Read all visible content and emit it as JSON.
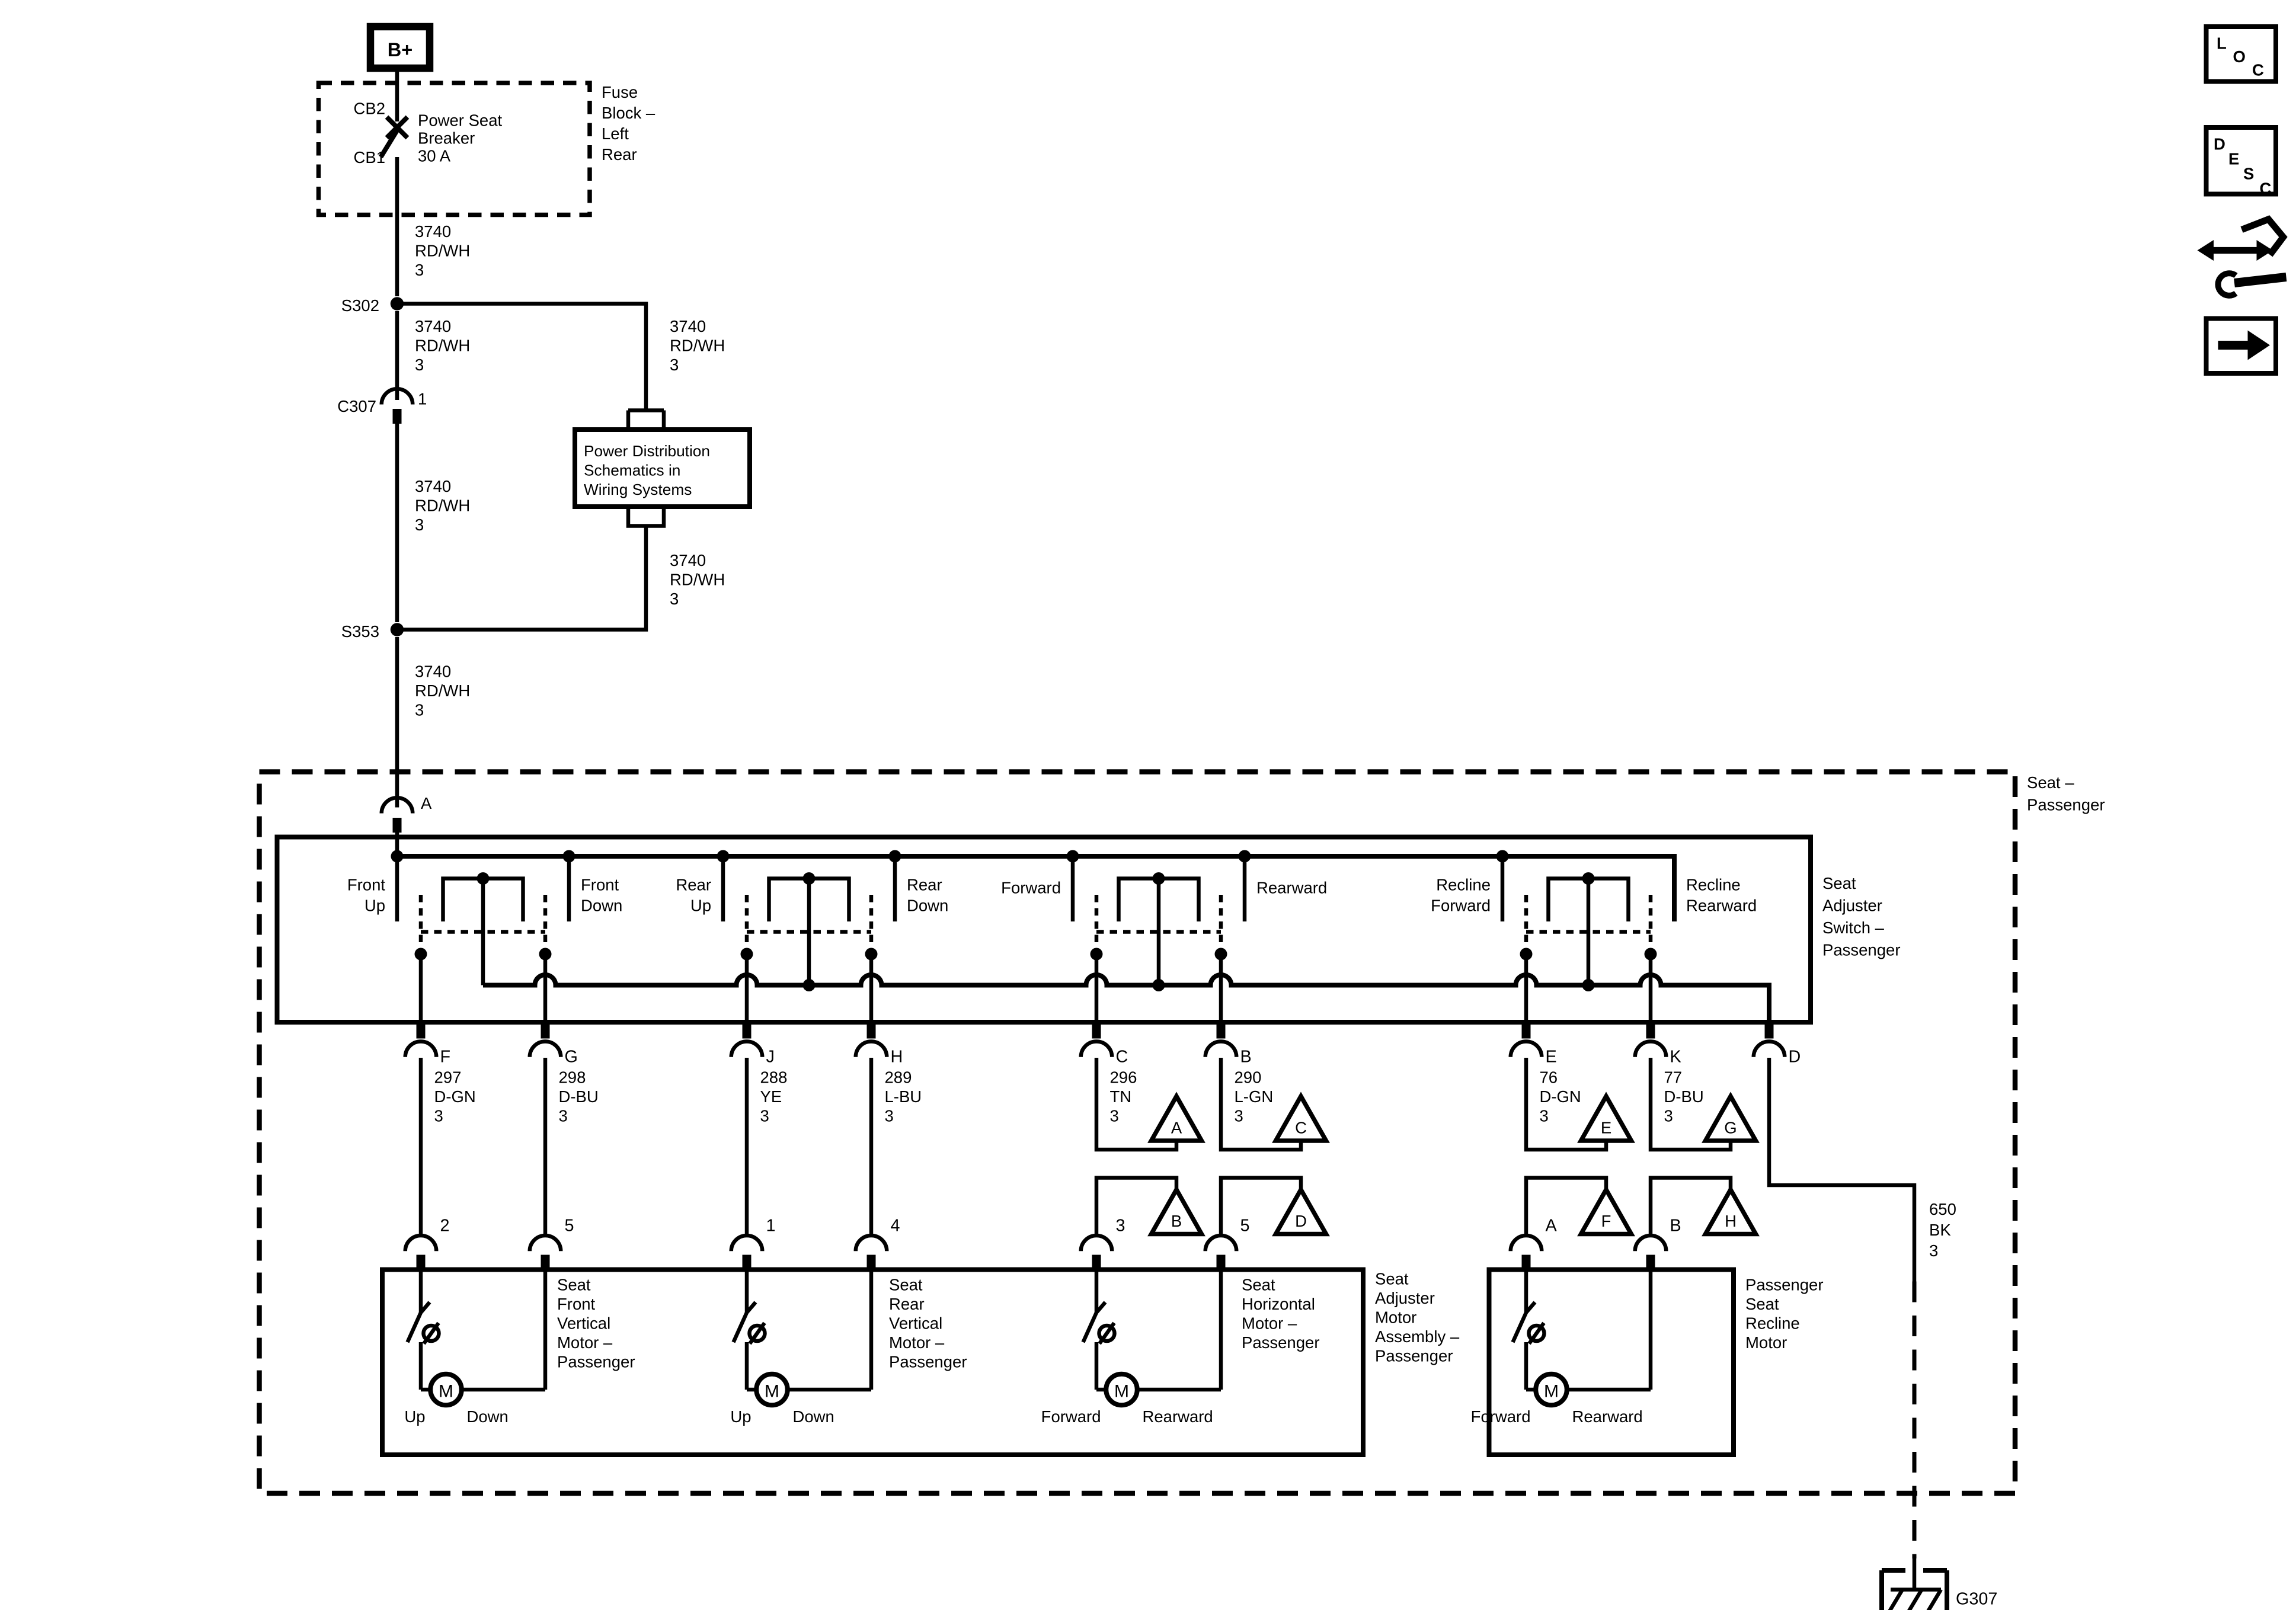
{
  "diagram": {
    "power": {
      "bplus": "B+",
      "cb2": "CB2",
      "cb1": "CB1",
      "breaker": [
        "Power Seat",
        "Breaker",
        "30 A"
      ],
      "fuse_block": [
        "Fuse",
        "Block –",
        "Left",
        "Rear"
      ],
      "wire_3740": [
        "3740",
        "RD/WH",
        "3"
      ],
      "s302": "S302",
      "c307": "C307",
      "c307_pin": "1",
      "s353": "S353",
      "pd_box": [
        "Power Distribution",
        "Schematics in",
        "Wiring Systems"
      ]
    },
    "seat": {
      "box_label": [
        "Seat –",
        "Passenger"
      ],
      "conn_a": "A",
      "switch": {
        "label": [
          "Seat",
          "Adjuster",
          "Switch –",
          "Passenger"
        ],
        "positions": {
          "s1l": [
            "Front",
            "Up"
          ],
          "s1r": [
            "Front",
            "Down"
          ],
          "s2l": [
            "Rear",
            "Up"
          ],
          "s2r": [
            "Rear",
            "Down"
          ],
          "s3l": [
            "Forward"
          ],
          "s3r": [
            "Rearward"
          ],
          "s4l": [
            "Recline",
            "Forward"
          ],
          "s4r": [
            "Recline",
            "Rearward"
          ]
        },
        "pins": {
          "f": "F",
          "g": "G",
          "j": "J",
          "h": "H",
          "c": "C",
          "b": "B",
          "e": "E",
          "k": "K",
          "d": "D"
        }
      },
      "wires": {
        "w297": [
          "297",
          "D-GN",
          "3"
        ],
        "w298": [
          "298",
          "D-BU",
          "3"
        ],
        "w288": [
          "288",
          "YE",
          "3"
        ],
        "w289": [
          "289",
          "L-BU",
          "3"
        ],
        "w296": [
          "296",
          "TN",
          "3"
        ],
        "w290": [
          "290",
          "L-GN",
          "3"
        ],
        "w76": [
          "76",
          "D-GN",
          "3"
        ],
        "w77": [
          "77",
          "D-BU",
          "3"
        ],
        "w650": [
          "650",
          "BK",
          "3"
        ]
      },
      "triangles": {
        "a": "A",
        "b": "B",
        "c": "C",
        "d": "D",
        "e": "E",
        "f": "F",
        "g": "G",
        "h": "H"
      },
      "motor_pins": {
        "p2": "2",
        "p5a": "5",
        "p1": "1",
        "p4": "4",
        "p3": "3",
        "p5b": "5",
        "pa": "A",
        "pb": "B"
      },
      "motors": {
        "m": "M",
        "front_vertical": [
          "Seat",
          "Front",
          "Vertical",
          "Motor –",
          "Passenger"
        ],
        "rear_vertical": [
          "Seat",
          "Rear",
          "Vertical",
          "Motor –",
          "Passenger"
        ],
        "horizontal": [
          "Seat",
          "Horizontal",
          "Motor –",
          "Passenger"
        ],
        "assembly": [
          "Seat",
          "Adjuster",
          "Motor",
          "Assembly –",
          "Passenger"
        ],
        "recline": [
          "Passenger",
          "Seat",
          "Recline",
          "Motor"
        ],
        "up": "Up",
        "down": "Down",
        "forward": "Forward",
        "rearward": "Rearward"
      },
      "ground": "G307"
    },
    "toolbar": {
      "loc": [
        "L",
        "O",
        "C"
      ],
      "desc": [
        "D",
        "E",
        "S",
        "C"
      ]
    }
  }
}
